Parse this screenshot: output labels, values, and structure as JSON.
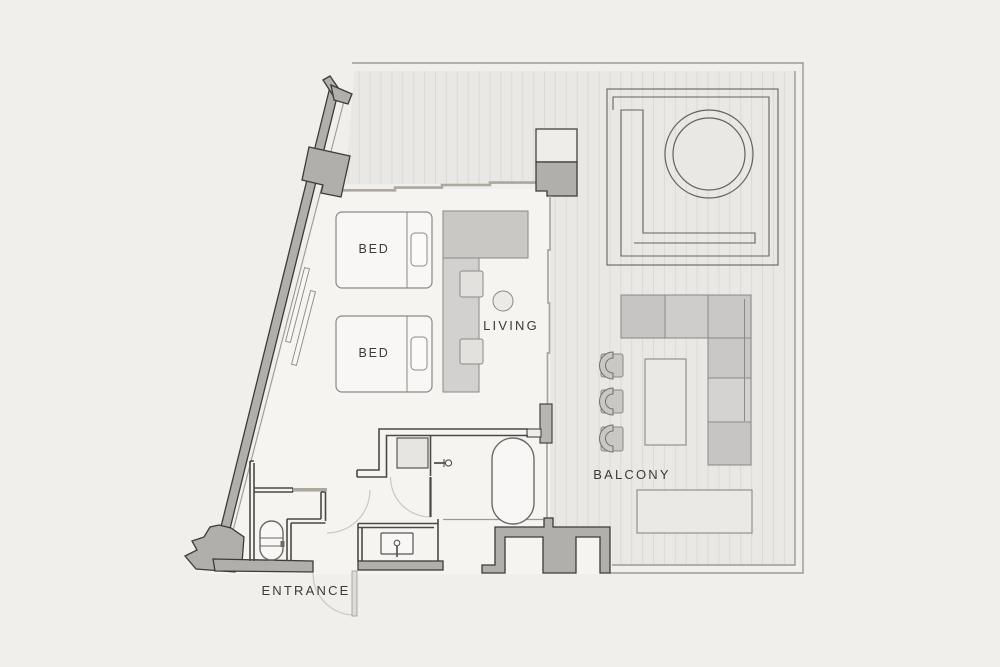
{
  "floorplan": {
    "type": "apartment-floor-plan",
    "labels": {
      "bed_1": "BED",
      "bed_2": "BED",
      "living": "LIVING",
      "balcony": "BALCONY",
      "entrance": "ENTRANCE"
    },
    "colors": {
      "page_background": "#f0efec",
      "interior_floor": "#f5f4f1",
      "balcony_floor": "#e9e8e5",
      "balcony_stripe": "#dbdad7",
      "structural_wall_fill": "#b0afac",
      "structural_wall_outline": "#3c3b38",
      "partition_wall": "#4a4944",
      "window_frame_tan": "#aea79e",
      "furniture_gray": "#c9c8c5",
      "furniture_light": "#eae9e6",
      "furniture_outline": "#8a8984",
      "fixture_outline": "#6b6a65",
      "door_swing": "#c9c8c5",
      "boundary_line": "#9b9a96",
      "label_text": "#3b3a38"
    },
    "fixtures": [
      "bed",
      "bed",
      "tv-console",
      "counter",
      "stool",
      "stool",
      "side-table",
      "bathtub",
      "shower",
      "toilet",
      "sink-vanity",
      "bath-door",
      "wc-door",
      "entrance-door",
      "outdoor-sofa",
      "outdoor-coffee-table",
      "outdoor-chair",
      "outdoor-chair",
      "outdoor-chair",
      "outdoor-lounger",
      "round-spa",
      "balcony-deck"
    ]
  }
}
